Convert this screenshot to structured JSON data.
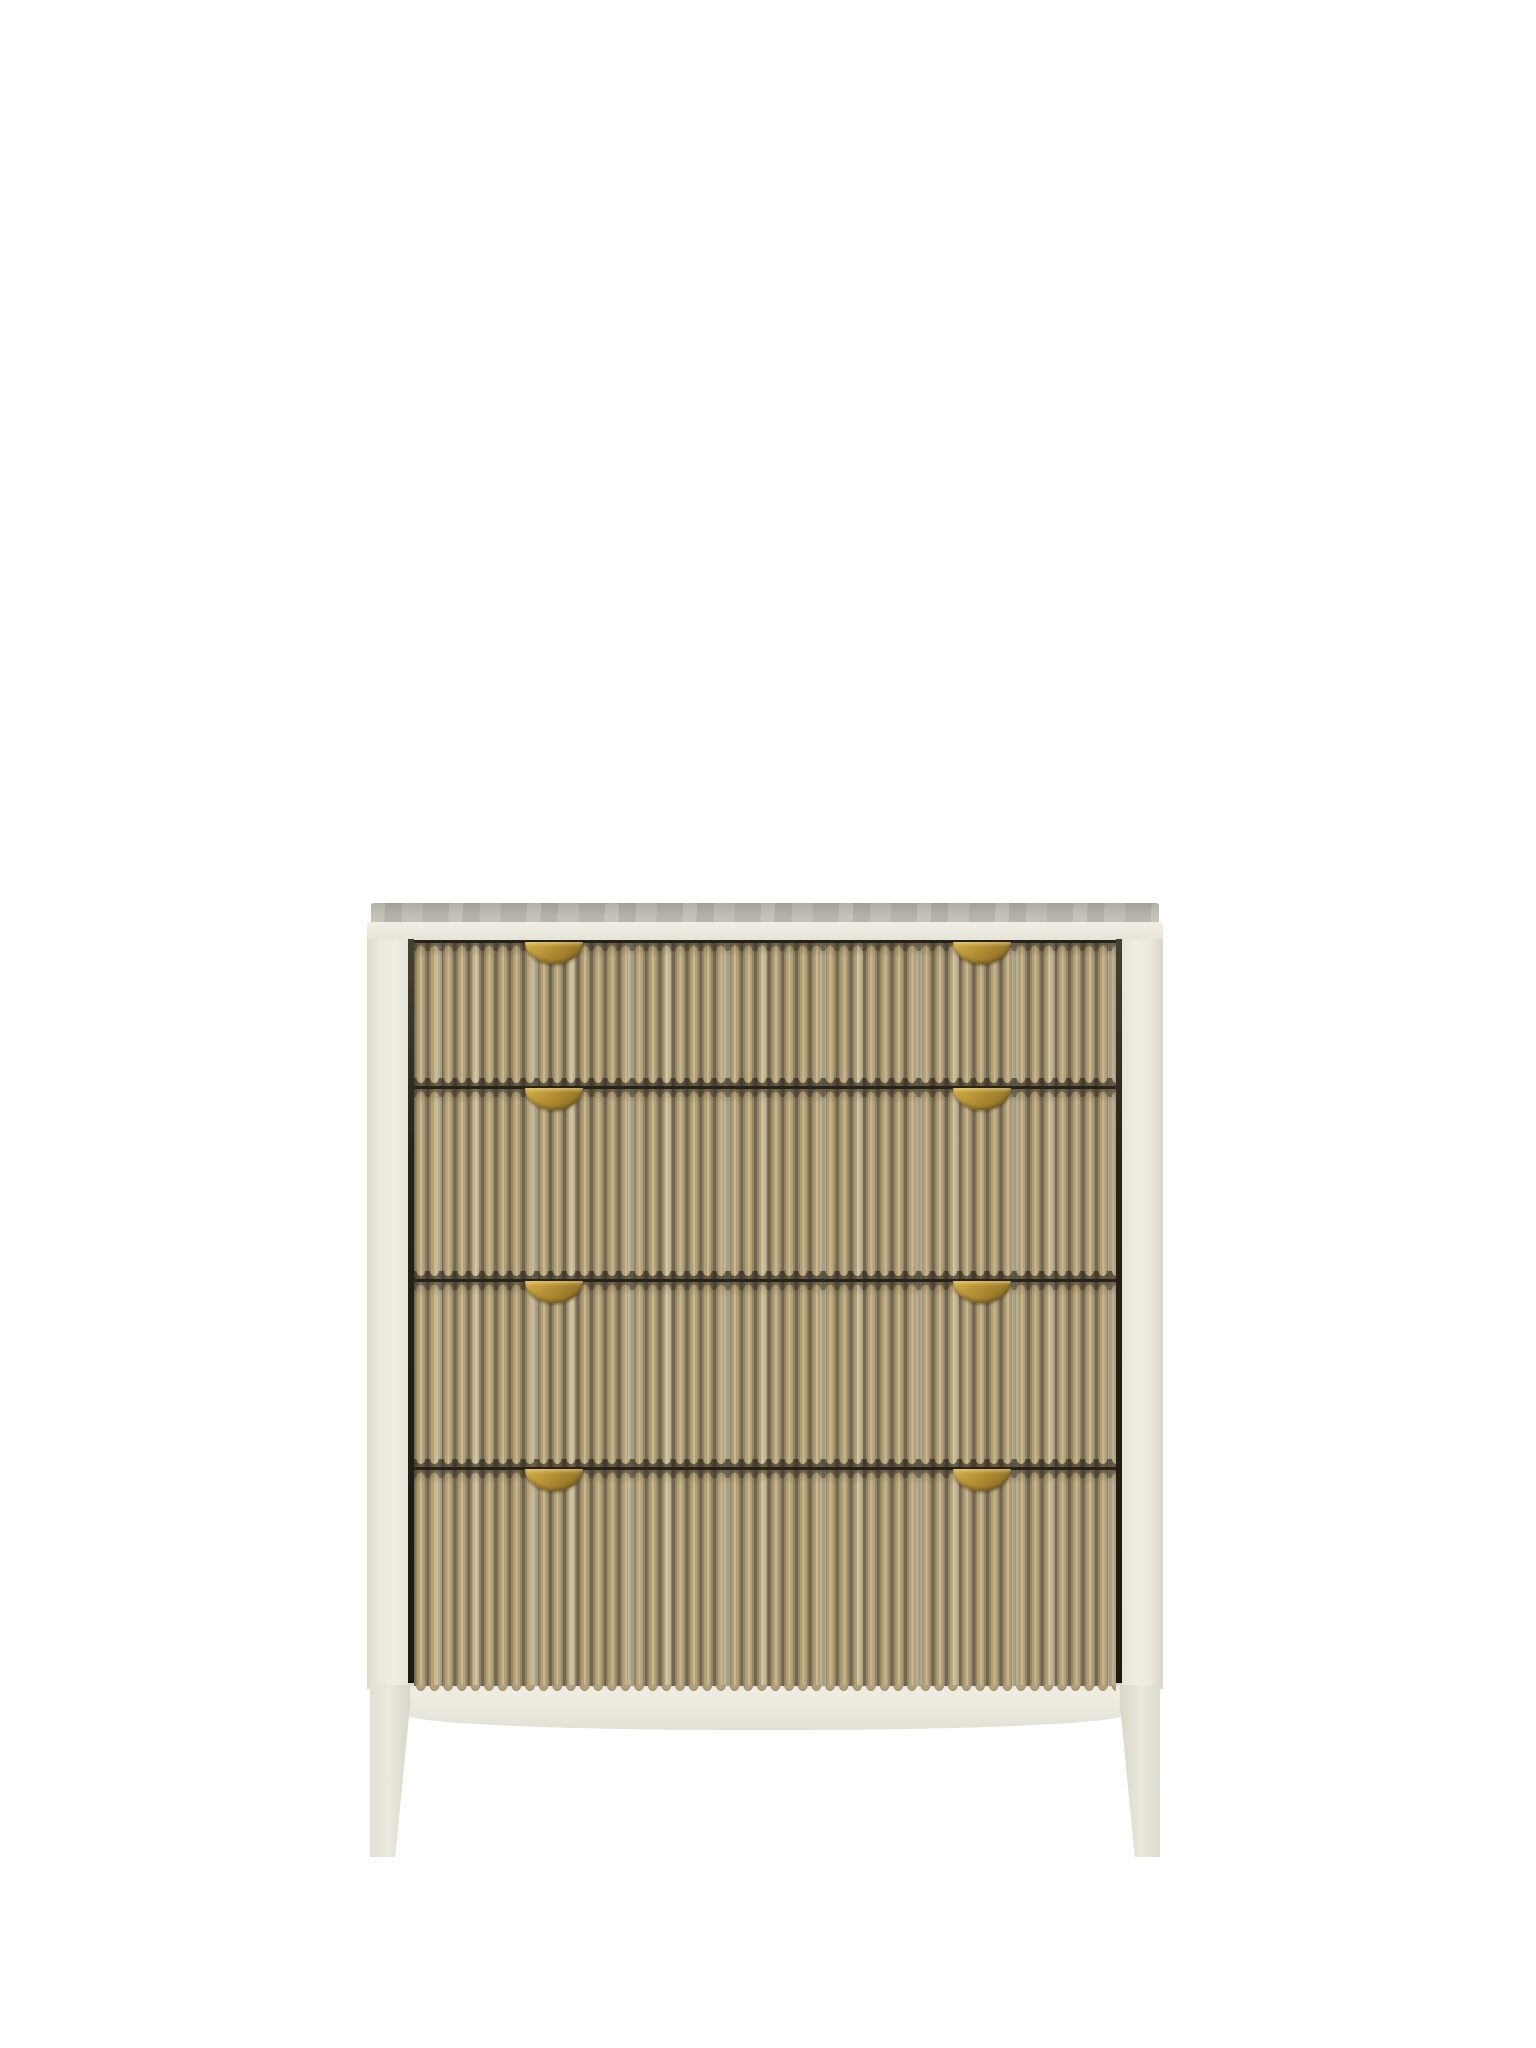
{
  "page": {
    "kind": "product-photo",
    "background": "#ffffff",
    "subject": "Bow-front chest of four drawers with an off-white painted frame, vertical reeded washed-oak drawer fronts and brass half-moon pull handles, shown on a plain white background with no text"
  },
  "colors": {
    "bg": "#ffffff",
    "frame": "#ebe9de",
    "frame_edge": "#c9c7bb",
    "top_surface": "#aaa79e",
    "top_surface_light": "#bfbcb3",
    "wood_base": "#b1a078",
    "wood_light": "#c9b98e",
    "wood_groove": "#6e6757",
    "gap_dark": "#26221a",
    "brass": "#a9862f",
    "brass_light": "#cfa944",
    "brass_dark": "#7d621f"
  },
  "chest": {
    "frame_finish": "off-white painted wood",
    "drawer_finish": "reeded light oak with whitewash",
    "handle_finish": "antique brass half-moon",
    "drawer_count": 4,
    "handles_per_drawer": 2,
    "leg_count_visible": 2,
    "drawers": [
      {
        "name": "drawer-1",
        "handles": [
          "left",
          "right"
        ]
      },
      {
        "name": "drawer-2",
        "handles": [
          "left",
          "right"
        ]
      },
      {
        "name": "drawer-3",
        "handles": [
          "left",
          "right"
        ]
      },
      {
        "name": "drawer-4",
        "handles": [
          "left",
          "right"
        ]
      }
    ]
  }
}
